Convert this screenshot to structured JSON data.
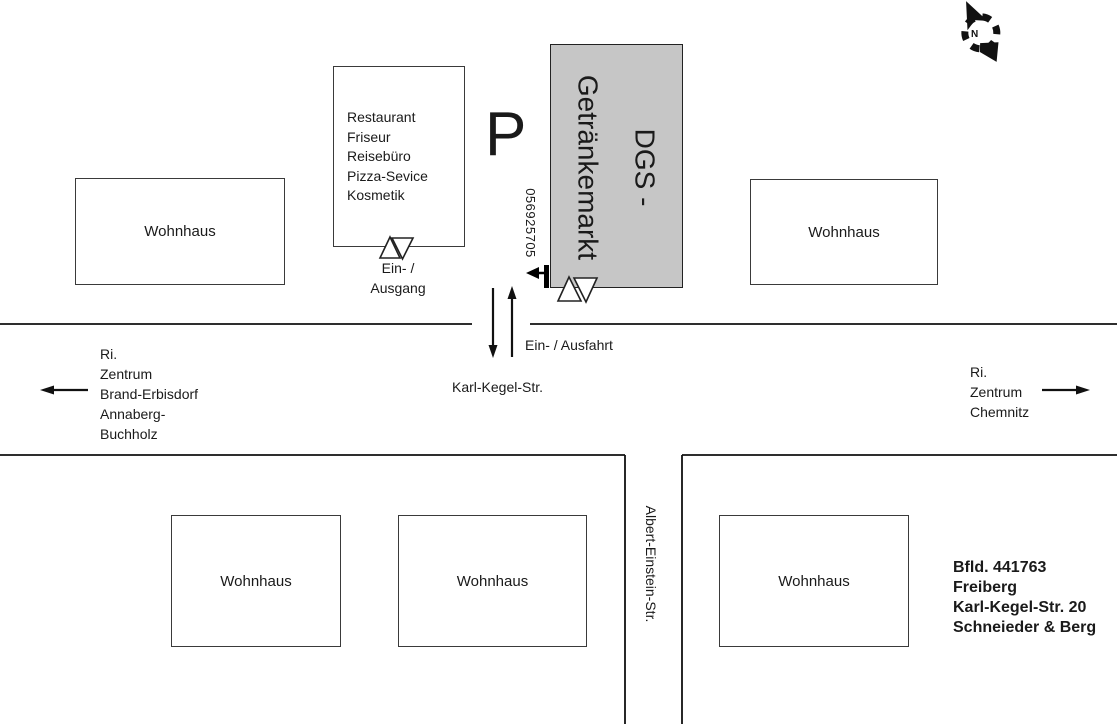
{
  "map": {
    "compass": {
      "label": "N"
    },
    "parking": {
      "symbol": "P"
    },
    "buildings": {
      "wohnhaus_label": "Wohnhaus",
      "services": {
        "lines": "Restaurant\nFriseur\nReisebüro\nPizza-Sevice\nKosmetik"
      },
      "dgs": {
        "name": "DGS -\nGetränkemarkt",
        "number": "056925705",
        "fill": "#c6c6c6"
      }
    },
    "entrances": {
      "services_entrance": "Ein- /\nAusgang",
      "driveway": "Ein- / Ausfahrt"
    },
    "streets": {
      "horizontal": "Karl-Kegel-Str.",
      "vertical": "Albert-Einstein-Str."
    },
    "directions": {
      "west": "Ri.\nZentrum\nBrand-Erbisdorf\nAnnaberg-\nBuchholz",
      "east": "Ri.\nZentrum\nChemnitz"
    },
    "address": {
      "lines": "Bfld. 441763\nFreiberg\nKarl-Kegel-Str. 20\nSchneieder & Berg"
    },
    "colors": {
      "ink": "#1a1a1a",
      "building_fill": "#c6c6c6"
    }
  }
}
